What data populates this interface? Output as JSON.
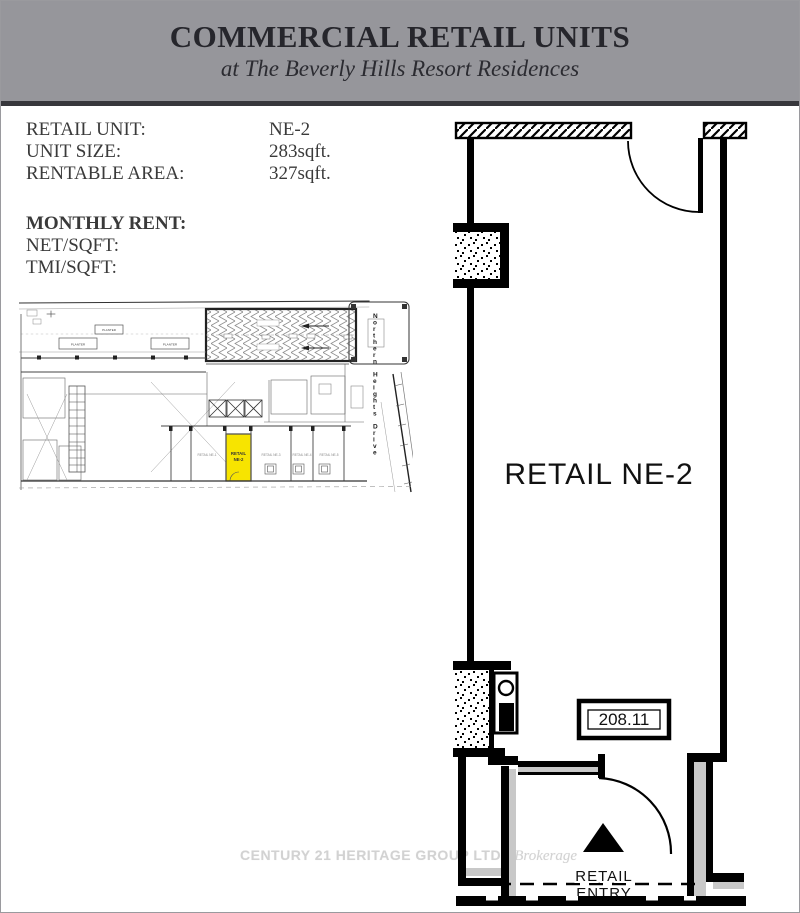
{
  "header": {
    "title": "COMMERCIAL RETAIL UNITS",
    "subtitle": "at The Beverly Hills Resort Residences"
  },
  "info": {
    "rows": [
      {
        "label": "RETAIL UNIT:",
        "value": "NE-2"
      },
      {
        "label": "UNIT SIZE:",
        "value": "283sqft."
      },
      {
        "label": "RENTABLE AREA:",
        "value": "327sqft."
      }
    ],
    "rent_heading": "MONTHLY RENT:",
    "rent_rows": [
      {
        "label": "NET/SQFT:"
      },
      {
        "label": "TMI/SQFT:"
      }
    ]
  },
  "site_plan": {
    "street_name": "Northern Heights Drive",
    "planter1": "PLANTER",
    "planter2": "PLANTER",
    "planter3": "PLANTER",
    "highlight_unit": {
      "line1": "RETAIL",
      "line2": "NE-2",
      "color": "#f7e400"
    },
    "neighbor_units": [
      "RETAIL NE-1",
      "RETAIL NE-3",
      "RETAIL NE-4",
      "RETAIL NE-5"
    ]
  },
  "main_plan": {
    "room_label": "RETAIL NE-2",
    "unit_number": "208.11",
    "entry_label_line1": "RETAIL",
    "entry_label_line2": "ENTRY"
  },
  "watermark": {
    "brand": "CENTURY 21 HERITAGE GROUP LTD.,",
    "suffix": "Brokerage"
  }
}
